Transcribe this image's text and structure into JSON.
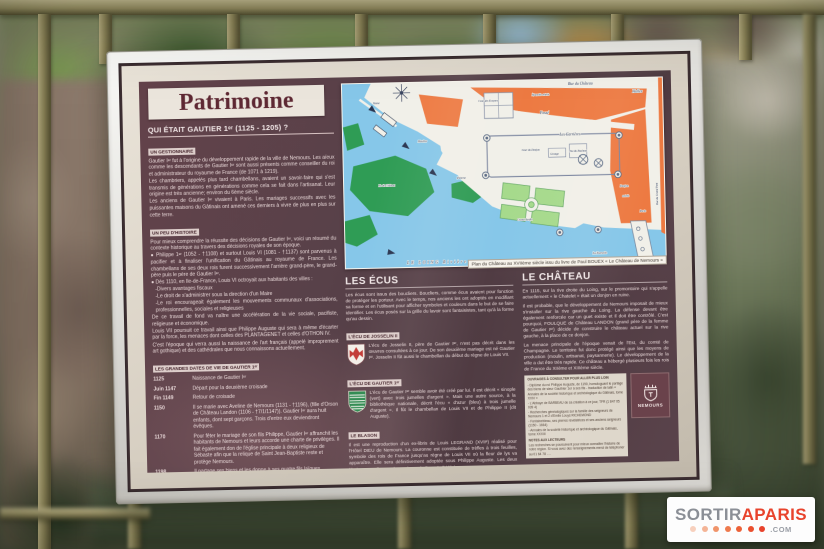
{
  "watermark": {
    "part1": "SORTIR",
    "part2": "APARIS",
    "part3": ".COM",
    "dot_colors": [
      "#f7d0bd",
      "#f4b496",
      "#f0946a",
      "#ee7a4d",
      "#ec6138",
      "#ea4f2e",
      "#e8432c"
    ]
  },
  "colors": {
    "panel_maroon": "#574049",
    "frame_white": "#e6e5e1",
    "map_water": "#86c7e9",
    "map_island": "#2f9c55",
    "map_garden": "#a6da8c",
    "map_building": "#ed7a42",
    "fence_olive": "#8a8257",
    "watermark_red": "#e8432c"
  },
  "panel": {
    "title": "Patrimoine",
    "question": "QUI ÉTAIT GAUTIER 1ᵉʳ (1125 - 1205) ?",
    "left": {
      "s1_label": "UN GESTIONNAIRE",
      "s1_p1": "Gautier Iᵉʳ fut à l'origine du développement rapide de la ville de Nemours. Les aïeux comme les descendants de Gautier Iᵉʳ sont aussi présents comme conseiller du roi et administrateur du royaume de France (de 1071 à 1219).",
      "s1_p2": "Les chambriers, appelés plus tard chambellans, avaient un savoir-faire qui s'est transmis de générations en générations comme cela se fait dans l'artisanat. Leur origine est très ancienne; environ du 6ème siècle.",
      "s1_p3": "Les anciens de Gautier Iᵉʳ vivaient à Paris. Les mariages successifs avec les puissantes maisons du Gâtinais ont amené ces derniers à vivre de plus en plus sur cette terre.",
      "s2_label": "UN PEU D'HISTOIRE",
      "s2_p1": "Pour mieux comprendre la réussite des décisions de Gautier Iᵉʳ, voici un résumé du contexte historique au travers des décisions royales de son époque.",
      "s2_b1": "● Philippe 1ᵉʳ (1052 - †1108) et surtout Louis VI (1081 - †1137) sont parvenus à pacifier et à finaliser l'unification du Gâtinais au royaume de France. Les chambellans de ses deux rois furent successivement l'arrière grand-père, le grand-père puis le père de Gautier Iᵉʳ.",
      "s2_b2": "● Dès 1110, en Ile-de-France, Louis VI octroyait aux habitants des villes :",
      "s2_l1": "-Divers avantages fiscaux",
      "s2_l2": "-Le droit de s'administrer sous la direction d'un Maire",
      "s2_l3": "-Le roi encourageait également les mouvements communaux d'associations, professionnelles, sociales et religieuses",
      "s2_p2": "De ce travail de fond va naître une accélération de la vie sociale, pacifiste, religieuse et économique.",
      "s2_p3": "Louis VII poursuit ce travail ainsi que Philippe Auguste qui sera à même d'écarter par la force, les menaces dont celles des PLANTAGENET et celles d'OTHON IV.",
      "s2_p4": "C'est l'époque qui verra aussi la naissance de l'art français (appelé improprement art gothique) et des cathédrales que nous connaissons actuellement.",
      "s3_label": "LES GRANDES DATES DE VIE DE GAUTIER 1ᵉʳ",
      "timeline": [
        {
          "date": "1125",
          "text": "Naissance de Gautier Iᵉʳ"
        },
        {
          "date": "Juin 1147",
          "text": "Départ pour la deuxième croisade"
        },
        {
          "date": "Fin 1149",
          "text": "Retour de croisade"
        },
        {
          "date": "1150",
          "text": "Il se marie avec Aveline de Nemours (1131 - †1196), (fille d'Orson de Château Landon (1106 - †7/1/1147)). Gautier Iᵉʳ aura huit enfants, dont sept garçons. Trois d'entre eux deviendront évêques."
        },
        {
          "date": "1170",
          "text": "Pour fêter le mariage de son fils Philippe, Gautier Iᵉʳ affranchit les habitants de Nemours et leurs accorde une charte de privilèges. Il fait également don de l'église principale à deux religieux de Sébaste afin que la relique de Saint Jean-Baptiste reste et protège Nemours."
        },
        {
          "date": "1198",
          "text": "Il partage ses biens et les donne à ses quatre fils laïques."
        },
        {
          "date": "1198 ou 1200",
          "text": "Gautier se remarie avec Peralis d'Aschère le Maréchal."
        },
        {
          "date": "Octobre 1205",
          "text": "Mort de Gautier Iᵉʳ à Méréville (Essonne). Il est inhumé à l'abbaye de BARBEAU (proche de Fontaine le Port) auprès du roi Louis VII."
        }
      ]
    },
    "map": {
      "caption": "Plan du Château au XVIIème siècle issu du livre de Paul BOUEX « Le Château de Nemours »",
      "labels": [
        "Rue du Château",
        "Nouvelle entrée",
        "Halles",
        "Fossé",
        "Les Carrières",
        "Cour du Donjon",
        "Grange",
        "Jeu du Paulmes",
        "Cour des Ecuyers",
        "Vanne",
        "Moulins",
        "Poterne",
        "Ile du Château",
        "Grand Jardin",
        "Donjon",
        "entrée",
        "Porte",
        "La Tournelle",
        "LE LOING Rivière",
        "Rue du Grand Pont"
      ]
    },
    "ecus": {
      "heading": "LES ÉCUS",
      "intro": "Les écus sont issus des boucliers. Boucliers, comme écus avaient pour fonction de protéger les porteur. Avec le temps, nos anciens les ont adoptés en modifiant sa forme et en l'utilisant pour afficher symboles et couleurs dans le but de se faire identifier. Les écus posés sur la grille du lavoir sont fantaisistes, tant qu'à la forme qu'au dessin.",
      "josselin_label": "L'ÉCU DE JOSSELIN II",
      "josselin_text": "L'écu de Josselin II, père de Gautier Iᵉʳ, n'est pas décrit dans les œuvres consultées à ce jour. De son deuxième mariage est né Gautier Iᵉʳ. Josselin II fût aussi le chambellan du début du règne de Louis VII.",
      "gautier_label": "L'ÉCU DE GAUTIER 1ᵉʳ",
      "gautier_text": "L'écu de Gautier Iᵉʳ semble avoir été créé par lui. Il est décrit « sinople (vert) avec trois jumelles d'argent ». Mais une autre source, à la bibliothèque nationale, décrit l'écu « d'azur (bleu) à trois jumelle d'argent ». Il fût le chambellan de Louis VII et de Philippe II (dit Auguste).",
      "blason_label": "LE BLASON",
      "blason_text": "Il est une reproduction d'un ex-libris de Louis LEGRAND (XVIIᵉ) réalisé pour l'Hôtel DIEU de Nemours. La couronne est constituée de trèfles à trois feuilles, symbole des rois de France jusqu'au règne de Louis VII où la fleur de lys va apparaître. Elle sera définitivement adoptée sous Philippe Auguste. Les deux lévriers sont dit regardants. Ils symbolisent la fidélité."
    },
    "chateau": {
      "heading": "LE CHÂTEAU",
      "p1": "En 1115, sur la rive droite du Loing, sur le promontoire qui s'appelle actuellement « le Chatelet » était un donjon en ruine.",
      "p2": "Il est probable, que le développement de Nemours imposait de mieux s'installer sur la rive gauche du Loing. La défense devant être également renforcée car un guet existe et il doit être contrôlé. C'est pourquoi, FOULQUE de Château LANDON (grand père de la femme de Gautier Iᵉʳ) décide de construire le château actuel sur la rive gauche, à la place de ce donjon.",
      "p3": "La menace principale de l'époque venait de l'Est, du comté de Champagne. Le territoire fut donc protégé ainsi que les moyens de production (moulin, artisanat, paysannerie). Le développement de la ville a dut être très rapide. Ce château a hébergé plusieurs fois les rois de France du XIIème et XIIIème siècle.",
      "refs_title": "OUVRAGES À CONSULTER POUR ALLER PLUS LOIN",
      "refs": [
        "- Diplôme du roi Philippe Auguste, de 1190, homologuant le partage des biens de sieur Gauthier 1er à ses fils - traduction de latin « Annales de la société historique et archéologique du Gâtinais, tome XXIV »",
        "- L'Abbaye de BARBEAU de sa création à ce jour, TFR (1 847 05 039 4)",
        "- Recherches généalogiques sur la famille des seigneurs de Nemours 1 et 2 d'Emile Louys RICHEMOND",
        "- Fontainebleau, ses pierres révélatrices et ses anciens seigneurs (1150 - 1664)",
        "- Annales de la société historique et archéologique du Gâtinais, tome XXXIII"
      ],
      "notes_title": "NOTES AUX LECTEURS",
      "notes": "Les recherches se poursuivent pour mieux connaître l'histoire de notre région. Si vous avez des renseignements merci de téléphoner au 01 64 78 .. ..",
      "logo_text": "NEMOURS"
    }
  }
}
